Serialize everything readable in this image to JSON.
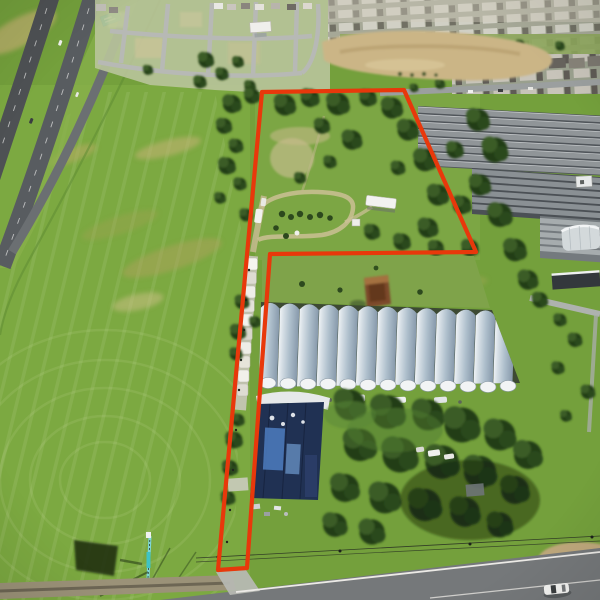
{
  "image": {
    "type": "aerial-drone-photograph",
    "description": "Aerial drone photo of a flag-shaped land parcel outlined in red, containing a tree-lined homestead lot and a long narrow access strip leading to a road; adjacent plant-nursery greenhouses, a shade-cloth nursery complex, a divided highway on the left, and residential subdivisions at the top.",
    "orientation": "oblique-overhead"
  },
  "annotations": {
    "boundary": {
      "label": "property boundary outline",
      "color": "#e8380b",
      "stroke_width": 4.2,
      "points": "262,92 404,90 476,252 270,254 247,568 218,570"
    }
  },
  "scene": {
    "highway": {
      "label": "divided highway with exit ramp",
      "sign_color": "#17a77e",
      "asphalt_color": "#53565a"
    },
    "development": {
      "label": "subdivision under construction with graded lots"
    },
    "subdivision": {
      "label": "dense residential neighborhood"
    },
    "sand_area": {
      "label": "cleared sandy ground",
      "color": "#cbb586"
    },
    "shade_nursery": {
      "label": "shade-cloth nursery structures",
      "color": "#8d9296"
    },
    "greenhouses": {
      "label": "row of quonset greenhouses",
      "count": 13,
      "roof_color": "#c3cdd4"
    },
    "warehouse": {
      "label": "shade/warehouse building with tarped roof",
      "roof_color": "#203153",
      "tarp_color": "#4d7cc0"
    },
    "access_strip": {
      "label": "narrow deeded access strip with parked trailers"
    },
    "field": {
      "label": "mowed green field",
      "color": "#74a03c"
    },
    "road": {
      "label": "two-lane road along bottom",
      "color": "#75787a"
    },
    "vehicle": {
      "label": "white car on road",
      "color": "#f4f4f2"
    },
    "tower": {
      "label": "small lattice tower",
      "accent_color": "#3fc4c4"
    }
  },
  "palette": {
    "grass": "#74a03c",
    "grass_light": "#93b655",
    "tree_dark": "#243d18",
    "tree_mid": "#3a5c26",
    "sand": "#cbb586",
    "white_line": "#eceae6",
    "boundary_red": "#e8380b"
  }
}
